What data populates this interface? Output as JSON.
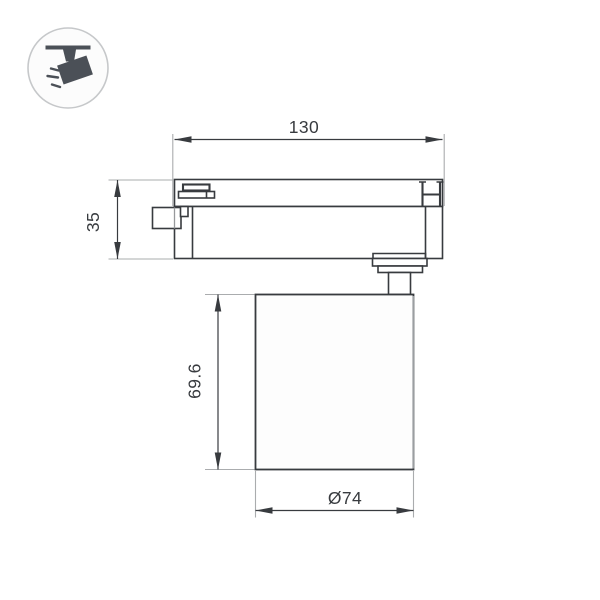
{
  "page": {
    "background": "#ffffff"
  },
  "legend_icon": {
    "name": "track-spotlight-icon",
    "circle_fill": "#fcfcfc",
    "circle_stroke": "#c6c8ca",
    "glyph_color": "#4b5057"
  },
  "drawing": {
    "line_color": "#383b3f",
    "extension_line_color": "#aaacae",
    "shadow_line_color": "#9b9ea1",
    "dimensions": {
      "track_length": {
        "label": "130"
      },
      "adapter_height": {
        "label": "35"
      },
      "body_height": {
        "label": "69.6"
      },
      "diameter": {
        "label": "Ø74"
      }
    }
  }
}
